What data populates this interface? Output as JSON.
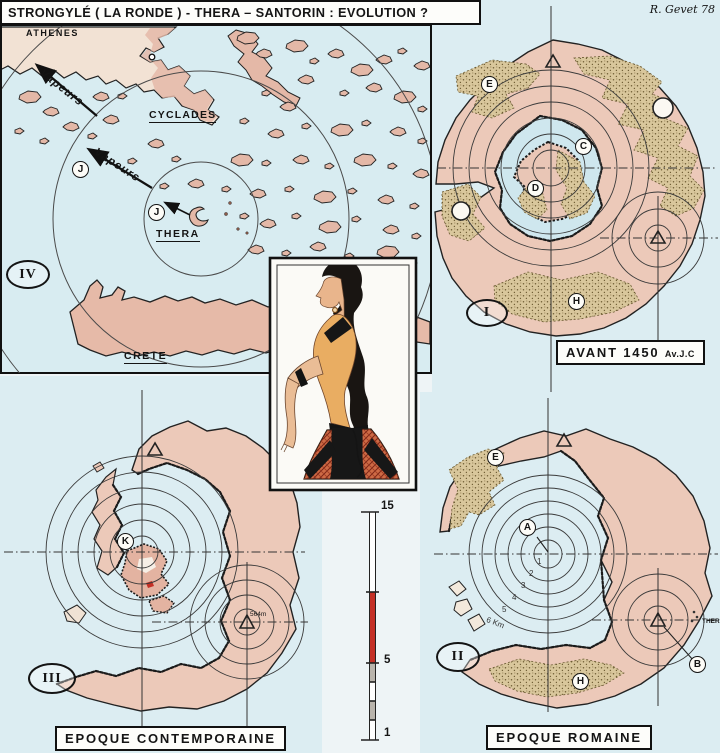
{
  "title": {
    "main": "STRONGYLÉ ( LA RONDE ) - THERA – SANTORIN : EVOLUTION ?",
    "signature": "R. Gevet 78"
  },
  "aegean_map": {
    "numeral": "IV",
    "athens": "ATHENES",
    "cyclades": "CYCLADES",
    "thera": "THERA",
    "crete": "CRETE",
    "vapor_north": "Vapeurs",
    "vapor_south": "Vapeurs",
    "marker_j_outer": "J",
    "marker_j_inner": "J"
  },
  "before_map": {
    "numeral": "I",
    "caption": "AVANT 1450",
    "caption_era": "Av.J.C",
    "marker_e": "E",
    "marker_c": "C",
    "marker_d": "D",
    "marker_h": "H"
  },
  "roman_map": {
    "numeral": "II",
    "caption": "EPOQUE ROMAINE",
    "marker_a": "A",
    "marker_b": "B",
    "marker_e": "E",
    "marker_h": "H",
    "ring_km_1": "1",
    "ring_km_2": "2",
    "ring_km_3": "3",
    "ring_km_4": "4",
    "ring_km_5": "5",
    "ring_km_6": "6 Km",
    "coast_town": "THERA"
  },
  "contemporary_map": {
    "numeral": "III",
    "caption": "EPOQUE CONTEMPORAINE",
    "marker_k": "K",
    "peak_elevation": "564m"
  },
  "scale_bar": {
    "top": "15",
    "middle": "5",
    "bottom": "1"
  },
  "colors": {
    "sea": "#d8ecf1",
    "land": "#e8c3b2",
    "pumice": "#d9c79c",
    "highlight_red": "#c43026"
  }
}
